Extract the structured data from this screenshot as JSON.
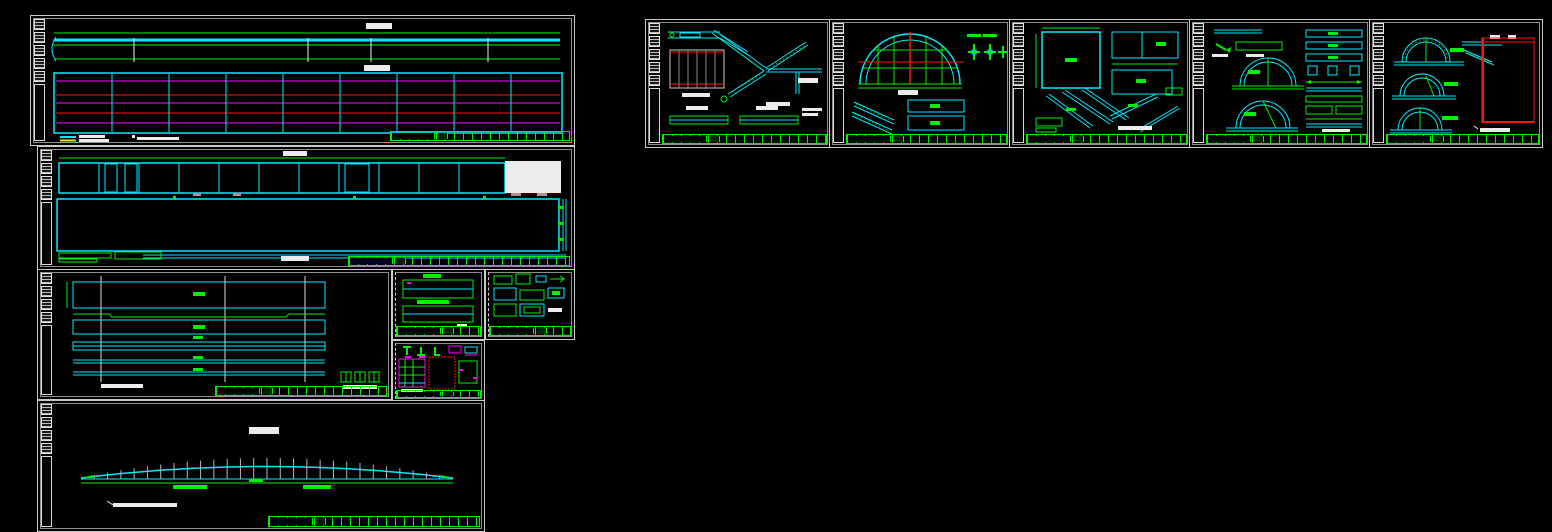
{
  "app": {
    "kind": "cad-model-space",
    "background": "#000000",
    "visible_text": "none-legible"
  },
  "palette": {
    "green": "#00f200",
    "cyan": "#00eaff",
    "magenta": "#ff00ff",
    "red": "#ff1414",
    "yellow": "#e8e800",
    "white": "#f0f0f0",
    "gray": "#9c9c9c",
    "frame": "#c9c9c9"
  },
  "sheets": [
    {
      "id": "sheet-girder-elevation-plan",
      "group": "left",
      "views": [
        "girder-elevation",
        "girder-rebar-plan",
        "legend",
        "title-bar"
      ]
    },
    {
      "id": "sheet-framing-plan",
      "group": "left",
      "views": [
        "striped-beam-strip",
        "deck-outline",
        "edge-bar",
        "legend",
        "title-bar"
      ]
    },
    {
      "id": "sheet-beam-details",
      "group": "left",
      "views": [
        "five-beam-strips",
        "rebar-schedule-column",
        "title-bar"
      ]
    },
    {
      "id": "sheet-cross-sections",
      "group": "middle",
      "views": [
        "section-top",
        "section-bottom",
        "title-bar"
      ]
    },
    {
      "id": "sheet-connection-details",
      "group": "middle",
      "views": [
        "detail-grid",
        "title-bar"
      ]
    },
    {
      "id": "sheet-embed-plates",
      "group": "middle",
      "views": [
        "anchor-shapes",
        "grid-panel",
        "dotted-plate",
        "title-bar"
      ]
    },
    {
      "id": "sheet-camber-diagram",
      "group": "left",
      "views": [
        "camber-truss",
        "baseline",
        "note",
        "title-bar"
      ]
    },
    {
      "id": "sheet-stair-details",
      "group": "right",
      "views": [
        "bracket",
        "data-table",
        "stair-stringer",
        "stringer-strips",
        "title-bar"
      ]
    },
    {
      "id": "sheet-dome-grid",
      "group": "right",
      "views": [
        "half-dome-grid",
        "cross-joints",
        "notes",
        "diagonal-members",
        "plates",
        "title-bar"
      ]
    },
    {
      "id": "sheet-plate-details",
      "group": "right",
      "views": [
        "square-plate",
        "split-plate",
        "plate",
        "diagonal-members",
        "title-bar"
      ]
    },
    {
      "id": "sheet-arch-rib-details-1",
      "group": "right",
      "views": [
        "top-bars",
        "two-half-arches",
        "beam-stack",
        "title-bar"
      ]
    },
    {
      "id": "sheet-arch-rib-details-2",
      "group": "right",
      "views": [
        "three-half-arches",
        "diagonal",
        "material-schedule-table",
        "title-bar"
      ]
    }
  ],
  "chart_data": {
    "type": "line",
    "title": "camber-diagram-profile",
    "x": "panel-points-0-28",
    "camber": {
      "panels": 28,
      "span_px": 372,
      "max_rise_px": 20,
      "base_y": 75,
      "start_x": 28
    }
  }
}
